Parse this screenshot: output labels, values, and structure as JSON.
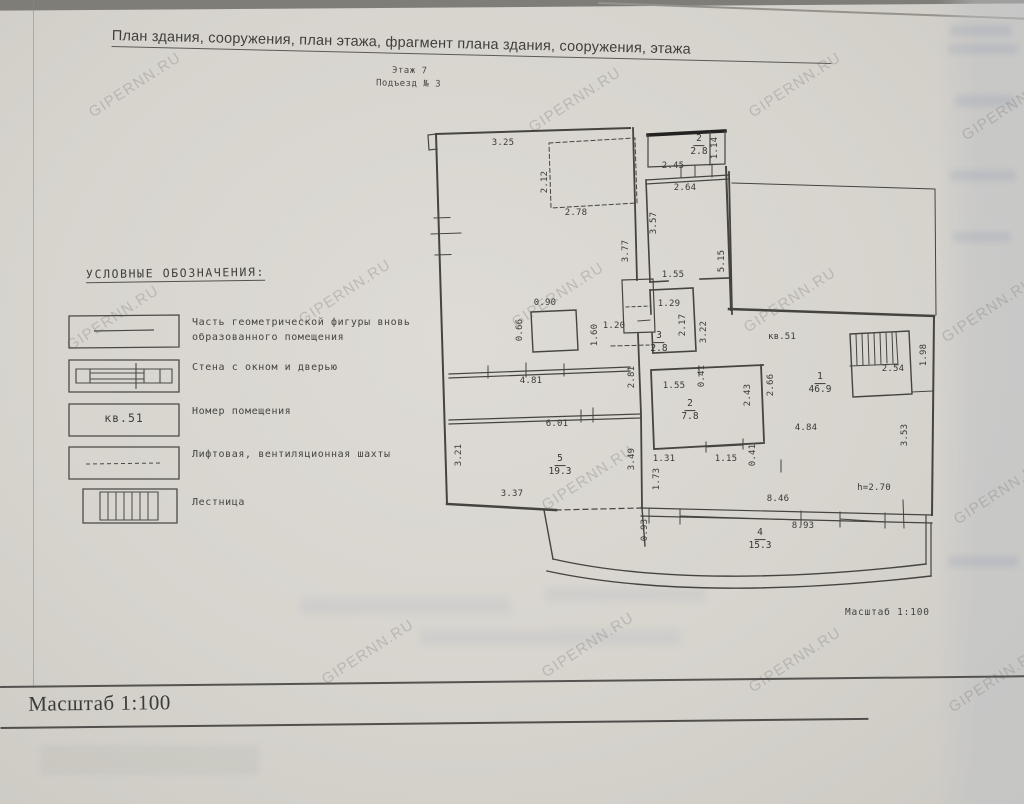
{
  "header": {
    "title": "План здания, сооружения, план этажа, фрагмент плана здания, сооружения, этажа",
    "floor": "Этаж 7",
    "entrance": "Подъезд № 3"
  },
  "legend": {
    "heading": "УСЛОВНЫЕ ОБОЗНАЧЕНИЯ:",
    "items": [
      {
        "symbol": "solid-line",
        "label": "Часть геометрической фигуры вновь образованного помещения"
      },
      {
        "symbol": "wall-window-door",
        "label": "Стена с окном и дверью"
      },
      {
        "symbol": "room-number",
        "symbol_text": "кв.51",
        "label": "Номер помещения"
      },
      {
        "symbol": "dashed-line",
        "label": "Лифтовая, вентиляционная шахты"
      },
      {
        "symbol": "stairs-hatch",
        "label": "Лестница"
      }
    ]
  },
  "plan": {
    "apartment_label": "кв.51",
    "height_note": "h=2.70",
    "scale_note": "Масштаб 1:100",
    "rooms": [
      {
        "number": "1",
        "area": "46.9",
        "x": 387,
        "y": 266
      },
      {
        "number": "2",
        "area": "7.8",
        "x": 257,
        "y": 293
      },
      {
        "number": "3",
        "area": "2.8",
        "x": 226,
        "y": 225
      },
      {
        "number": "4",
        "area": "15.3",
        "x": 327,
        "y": 422
      },
      {
        "number": "5",
        "area": "19.3",
        "x": 127,
        "y": 348
      },
      {
        "number": "2",
        "area": "2.8",
        "x": 266,
        "y": 28
      }
    ],
    "dimensions": [
      {
        "t": "3.25",
        "x": 70,
        "y": 25
      },
      {
        "t": "2.12",
        "x": 112,
        "y": 64,
        "v": 1
      },
      {
        "t": "2.78",
        "x": 143,
        "y": 95
      },
      {
        "t": "3.77",
        "x": 193,
        "y": 133,
        "v": 1
      },
      {
        "t": "0.90",
        "x": 112,
        "y": 185
      },
      {
        "t": "0.66",
        "x": 87,
        "y": 212,
        "v": 1
      },
      {
        "t": "1.20",
        "x": 181,
        "y": 208
      },
      {
        "t": "1.60",
        "x": 162,
        "y": 217,
        "v": 1
      },
      {
        "t": "4.81",
        "x": 98,
        "y": 263
      },
      {
        "t": "6.01",
        "x": 124,
        "y": 306
      },
      {
        "t": "3.21",
        "x": 26,
        "y": 337,
        "v": 1
      },
      {
        "t": "3.37",
        "x": 79,
        "y": 376
      },
      {
        "t": "3.49",
        "x": 199,
        "y": 341,
        "v": 1
      },
      {
        "t": "2.81",
        "x": 199,
        "y": 259,
        "v": 1
      },
      {
        "t": "2.45",
        "x": 240,
        "y": 48
      },
      {
        "t": "1.14",
        "x": 282,
        "y": 30,
        "v": 1
      },
      {
        "t": "2.64",
        "x": 252,
        "y": 70
      },
      {
        "t": "3.57",
        "x": 221,
        "y": 105,
        "v": 1
      },
      {
        "t": "5.15",
        "x": 289,
        "y": 143,
        "v": 1
      },
      {
        "t": "1.55",
        "x": 240,
        "y": 157
      },
      {
        "t": "1.29",
        "x": 236,
        "y": 186
      },
      {
        "t": "2.17",
        "x": 250,
        "y": 207,
        "v": 1
      },
      {
        "t": "3.22",
        "x": 271,
        "y": 214,
        "v": 1
      },
      {
        "t": "1.55",
        "x": 241,
        "y": 268
      },
      {
        "t": "0.41",
        "x": 269,
        "y": 258,
        "v": 1
      },
      {
        "t": "2.43",
        "x": 315,
        "y": 277,
        "v": 1
      },
      {
        "t": "2.66",
        "x": 338,
        "y": 267,
        "v": 1
      },
      {
        "t": "1.31",
        "x": 231,
        "y": 341
      },
      {
        "t": "1.15",
        "x": 293,
        "y": 341
      },
      {
        "t": "0.41",
        "x": 320,
        "y": 337,
        "v": 1
      },
      {
        "t": "1.73",
        "x": 224,
        "y": 361,
        "v": 1
      },
      {
        "t": "0.93",
        "x": 212,
        "y": 412,
        "v": 1
      },
      {
        "t": "кв.51",
        "x": 349,
        "y": 219
      },
      {
        "t": "4.84",
        "x": 373,
        "y": 310
      },
      {
        "t": "3.53",
        "x": 472,
        "y": 317,
        "v": 1
      },
      {
        "t": "2.54",
        "x": 460,
        "y": 251
      },
      {
        "t": "1.98",
        "x": 491,
        "y": 237,
        "v": 1
      },
      {
        "t": "h=2.70",
        "x": 441,
        "y": 370
      },
      {
        "t": "8.46",
        "x": 345,
        "y": 381
      },
      {
        "t": "8.93",
        "x": 370,
        "y": 408
      }
    ]
  },
  "footer": {
    "scale_label": "Масштаб 1:100"
  },
  "watermark": {
    "text": "GIPERNN.RU",
    "positions": [
      [
        135,
        85
      ],
      [
        575,
        100
      ],
      [
        795,
        85
      ],
      [
        1008,
        108
      ],
      [
        113,
        318
      ],
      [
        345,
        292
      ],
      [
        558,
        295
      ],
      [
        790,
        300
      ],
      [
        988,
        310
      ],
      [
        588,
        478
      ],
      [
        1000,
        492
      ],
      [
        368,
        652
      ],
      [
        588,
        645
      ],
      [
        795,
        660
      ],
      [
        995,
        680
      ]
    ]
  }
}
